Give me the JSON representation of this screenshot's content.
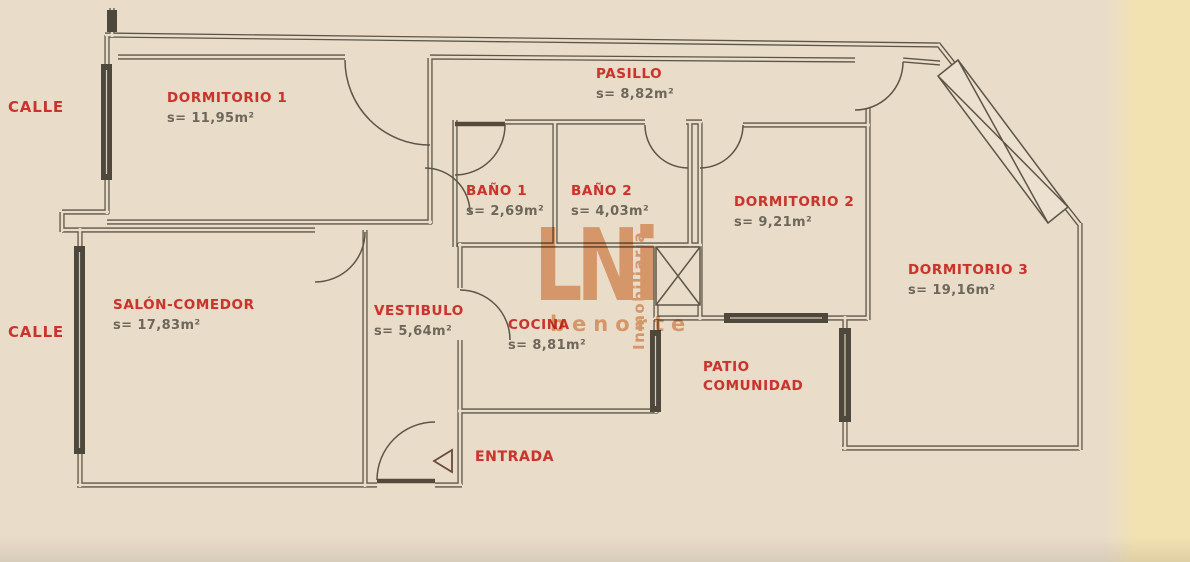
{
  "street_labels": {
    "top": "CALLE",
    "bottom": "CALLE"
  },
  "rooms": {
    "dormitorio1": {
      "name": "DORMITORIO 1",
      "area": "s= 11,95m²"
    },
    "pasillo": {
      "name": "PASILLO",
      "area": "s= 8,82m²"
    },
    "bano1": {
      "name": "BAÑO 1",
      "area": "s= 2,69m²"
    },
    "bano2": {
      "name": "BAÑO 2",
      "area": "s= 4,03m²"
    },
    "dormitorio2": {
      "name": "DORMITORIO 2",
      "area": "s= 9,21m²"
    },
    "dormitorio3": {
      "name": "DORMITORIO 3",
      "area": "s= 19,16m²"
    },
    "salon": {
      "name": "SALÓN-COMEDOR",
      "area": "s= 17,83m²"
    },
    "vestibulo": {
      "name": "VESTIBULO",
      "area": "s= 5,64m²"
    },
    "cocina": {
      "name": "COCINA",
      "area": "s= 8,81m²"
    },
    "patio": {
      "line1": "PATIO",
      "line2": "COMUNIDAD"
    },
    "entrada": {
      "name": "ENTRADA"
    }
  },
  "watermark": {
    "logo": "LNi",
    "vertical": "Inmobiliaria",
    "brand": "benorte"
  },
  "colors": {
    "paper": "#e9ddca",
    "paper_strip": "#f2e2b2",
    "wall": "#5d5547",
    "label_red": "#c9352c",
    "area_gray": "#6e675a",
    "watermark_orange": "#dd7a38"
  }
}
